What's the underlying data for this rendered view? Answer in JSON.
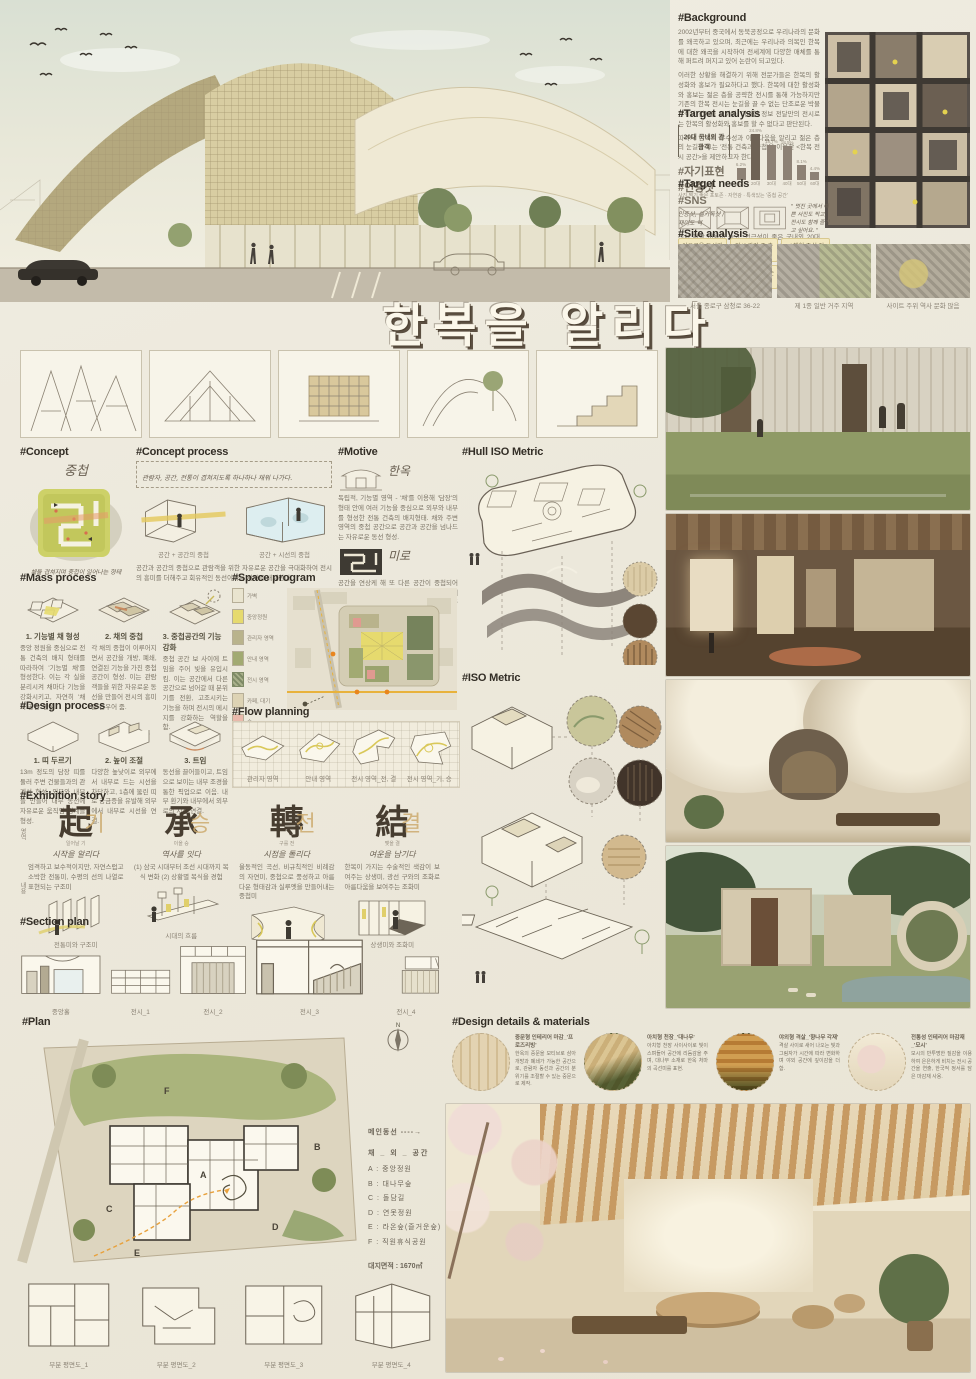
{
  "board": {
    "title": "한복을 알리다",
    "subtitle": "_중첩공간으로 흥미로움을 더하다"
  },
  "background": {
    "heading": "#Background",
    "p1": "2002년부터 중국에서 동북공정으로 우리나라의 문화를 왜곡하고 있으며, 최근에는 우리나라 의복인 한복에 대한 왜곡을 시작하여 전세계에 다양한 매체를 통해 퍼트려 퍼지고 있어 논란이 되고있다.",
    "p2": "이러한 상황을 해결하기 위해 전문가들은 한복의 활성화와 홍보가 필요하다고 했다. 한복에 대한 활성화와 홍보는 젊은 층을 공략한 전시를 통해 가능하지만 기존의 한복 전시는 눈길을 끌 수 없는 단조로운 박물관식의 전시를 보이며, 이러한 정보 전달만의 전시로는 한복의 활성화와 홍보를 할 수 없다고 판단된다.",
    "p3": "따라서 한복의 우수성과 아름다움을 알리고 젊은 층의 눈길을 끄는 '전통 건축과 중첩'을 이용한 <한복 전시 공간>을 제안하고자 한다."
  },
  "chart_data": {
    "type": "bar",
    "title": "20대 국내외 관광객",
    "categories": [
      "10대",
      "20대",
      "30대",
      "40대",
      "50대",
      "60대"
    ],
    "values": [
      6.2,
      24.8,
      18.7,
      18.5,
      8.1,
      4.4
    ],
    "value_labels": [
      "6.2%",
      "24.8%",
      "18.7%",
      "18.5%",
      "8.1%",
      "4.4%"
    ],
    "xlabel": "",
    "ylabel": "",
    "ylim": [
      0,
      28
    ],
    "legend": "none",
    "grid": false
  },
  "target_analysis": {
    "heading": "#Target analysis",
    "bracket_label": "20대 국내외 관광객",
    "hashtags": "#자기표현 #인증샷 #SNS",
    "hash_note": "인증샷, 셀카독샷 / 재미도 역",
    "caption": "전시 관람 비율이 높고, 접근성이 좋은 국내외 20대 관광객을 주 타겟으로 설정. 이들의 성향은 SNS 플랫폼을 이용한 자기표현, 인증샷과 색다른 경험을 추구."
  },
  "target_needs": {
    "heading": "#Target needs",
    "note": "사진 찍기 좋은 포토존 · 자연광 · 특색있는 '중첩 공간'",
    "quote": "\" 멋진 곳에서 예쁜 사진도 찍고, 전시도 함께 즐기고 싶어요. \"",
    "tags": [
      "여유로운 동선과 쉬어가는 설계",
      "전시 관람 중 충분한 휴식공간",
      "✓ 체험 중심 전시관",
      "동선이 자유롭고 재미있는",
      "즐기며 체험하는 전시",
      "✓ 감성 충만 전시관"
    ]
  },
  "site_analysis": {
    "heading": "#Site analysis",
    "captions": [
      "서울 종로구 삼청로 36-22",
      "제 1종 일반 거주 지역",
      "사이트 주위 역사 문화 많음"
    ]
  },
  "concept": {
    "heading": "#Concept",
    "keyword": "중첩",
    "caption": "채들 겹쳐지며 중첩이 일어나는 형태"
  },
  "concept_process": {
    "heading": "#Concept process",
    "handwriting": "관람자, 공간, 전통이 겹쳐지도록 하나하나 채워 나가다.",
    "captions": [
      "공간 + 공간의 중첩",
      "공간 + 시선의 중첩"
    ],
    "body": "공간과 공간의 중첩으로 관람객을 위한 자유로운 공간을 극대화하여 전시의 흥미를 더해주고 회유적인 동선이라는 서사를 내재한다."
  },
  "motive": {
    "heading": "#Motive",
    "items": [
      {
        "keyword": "한옥",
        "body": "독립적, 기능별 영역 - '채'를 이용해 '담장'의 형태 안에 여러 기능을 중심으로 외부와 내부를 형성한 전통 건축의 배치형태. 채와 주변 영역의 중첩 공간으로 공간과 공간을 넘나드는 자유로운 동선 형성."
      },
      {
        "keyword": "미로",
        "body": "공간을 연상케 해 또 다른 공간이 중첩되어 연결되면 서로 다른 느낌을 주고, 관람자들에게 흥미와 호기심을 지속적으로 유지시켜 주는 역할."
      }
    ]
  },
  "mass_process": {
    "heading": "#Mass process",
    "steps": [
      {
        "title": "1. 기능별 채 형성",
        "body": "중앙 정원을 중심으로 전통 건축의 배치 형태를 따라하여 '기능별 채'를 형성한다. 이는 각 실을 분리시켜 채마다 기능을 강화시키고, 자연히 '채 외 공간' 형성."
      },
      {
        "title": "2. 채의 중첩",
        "body": "각 채의 중첩이 이루어지면서 공간을 개방, 폐쇄, 연결된 기능을 가진 중첩 공간이 형성. 이는 관람객들을 위한 자유로운 동선을 만들어 전시의 흥미를 돋우어 줌."
      },
      {
        "title": "3. 중첩공간의 기능 강화",
        "body": "중첩 공간 보 사이에 트임을 주어 빛을 유입시킴. 이는 공간에서 다른 공간으로 넘어갈 때 분위기를 전환, 고조시키는 기능을 하며 전시의 메시지를 강화하는 역할을 함."
      }
    ]
  },
  "space_program": {
    "heading": "#Space program",
    "legend": [
      {
        "label": "가벽",
        "color": "#e9e4cf"
      },
      {
        "label": "중앙정원",
        "color": "#e6da6e"
      },
      {
        "label": "관리자 영역",
        "color": "#b9b38c"
      },
      {
        "label": "안내 영역",
        "color": "#a2aa72"
      },
      {
        "label": "전시 영역",
        "color": "#7e8a66"
      },
      {
        "label": "카페, 대기",
        "color": "#ddd3b4"
      },
      {
        "label": "숲",
        "color": "#e9b9ab"
      }
    ]
  },
  "design_process": {
    "heading": "#Design process",
    "steps": [
      {
        "title": "1. 띠 두르기",
        "body": "13m 정도의 담장 띠를 둘러 주변 건물들과의 관계성 형성. 외부와 내부를 만들어 내부 동선에 자유로운 움직임 경계를 형성."
      },
      {
        "title": "2. 높이 조절",
        "body": "다양한 높낮이로 외부에서 내부로 드는 시선을 차단하고, 1층에 뚫린 띠로 궁금증을 유발해 외부에서 내부로 시선을 연결."
      },
      {
        "title": "3. 트임",
        "body": "동선을 끌어들이고, 트임으로 보이는 내부 조경을 통한 픽업으로 이음. 내부 환기와 내부에서 외부로의 시선 연결."
      }
    ]
  },
  "flow_planning": {
    "heading": "#Flow planning",
    "captions": [
      "관리자 영역",
      "안내 영역",
      "전시 영역_전, 결",
      "전시 영역_기, 승"
    ]
  },
  "hull_iso": {
    "heading": "#Hull ISO Metric"
  },
  "iso_metric": {
    "heading": "#ISO Metric"
  },
  "exhibition_story": {
    "heading": "#Exhibition story",
    "row_labels": [
      "영역",
      "내용"
    ],
    "stages": [
      {
        "hanja": "起",
        "hangul": "기",
        "reading": "일어날 기",
        "phrase": "시작을 알리다",
        "body": "엄격하고 보수적이지만, 자연스럽고 소박한 전통미, 수평의 선의 나열로 표현되는 구조미",
        "caption": "전통미와 구조미"
      },
      {
        "hanja": "承",
        "hangul": "승",
        "reading": "이을 승",
        "phrase": "역사를 잇다",
        "body": "(1) 삼국 시대부터 조선 시대까지 복식 변화 (2) 상황별 복식을 경험",
        "caption": "시대의 흐름"
      },
      {
        "hanja": "轉",
        "hangul": "전",
        "reading": "구를 전",
        "phrase": "시점을 돌리다",
        "body": "율동적인 곡선, 비규칙적인 비례감의 자연미, 중첩으로 풍성하고 아름다운 형태감과 실루엣을 만들어내는 중첩미",
        "caption": "자연미와 중첩미"
      },
      {
        "hanja": "結",
        "hangul": "결",
        "reading": "맺을 결",
        "phrase": "여운을 남기다",
        "body": "한복이 가지는 수술적인 색감이 보여주는 상생미, 광선 구와의 조화로 아름다움을 보여주는 조화미",
        "caption": "상생미와 조화미"
      }
    ]
  },
  "section_plan": {
    "heading": "#Section plan",
    "captions": [
      "중앙홀",
      "전시_1",
      "전시_2",
      "전시_3",
      "전시_4"
    ]
  },
  "plan": {
    "heading": "#Plan",
    "flow_label": "메인동선 ----→",
    "list_title": "채 _ 외 _ 공간",
    "items": [
      "A : 중앙정원",
      "B : 대나무숲",
      "C : 돌담길",
      "D : 연못정원",
      "E : 라온숲(즐거운숲)",
      "F : 직원휴식공원"
    ],
    "area": "대지면적 : 1670㎡",
    "letters": [
      "A",
      "B",
      "C",
      "D",
      "E",
      "F"
    ],
    "sub_captions": [
      "부분 평면도_1",
      "부분 평면도_2",
      "부분 평면도_3",
      "부분 평면도_4"
    ]
  },
  "design_details": {
    "heading": "#Design details & materials",
    "items": [
      {
        "title": "중문형 인테리어 마감_'프로즈리빙'",
        "body": "한옥의 중문을 모티브로 삼아 개방과 폐쇄가 가능한 공간으로, 관람자 동선과 공간의 분위기를 조절할 수 있는 중문으로 제작."
      },
      {
        "title": "아치형 천장_'대나무'",
        "body": "아치형 천장 사이사이로 빛이 스며들어 공간에 리듬감을 주며, 대나무 소재로 한옥 처마의 곡선미를 표현."
      },
      {
        "title": "야외형 격살_'향나무 각재'",
        "body": "격살 사이로 새어 나오는 빛과 그림자가 시간에 따라 변화하며 야외 공간에 깊이감을 더함."
      },
      {
        "title": "전통성 인테리어 마감재_'모시'",
        "body": "모시의 반투명한 질감을 이용하여 은은하게 비치는 전시 공간을 연출, 한국적 정서를 담은 마감재 사용."
      }
    ]
  }
}
